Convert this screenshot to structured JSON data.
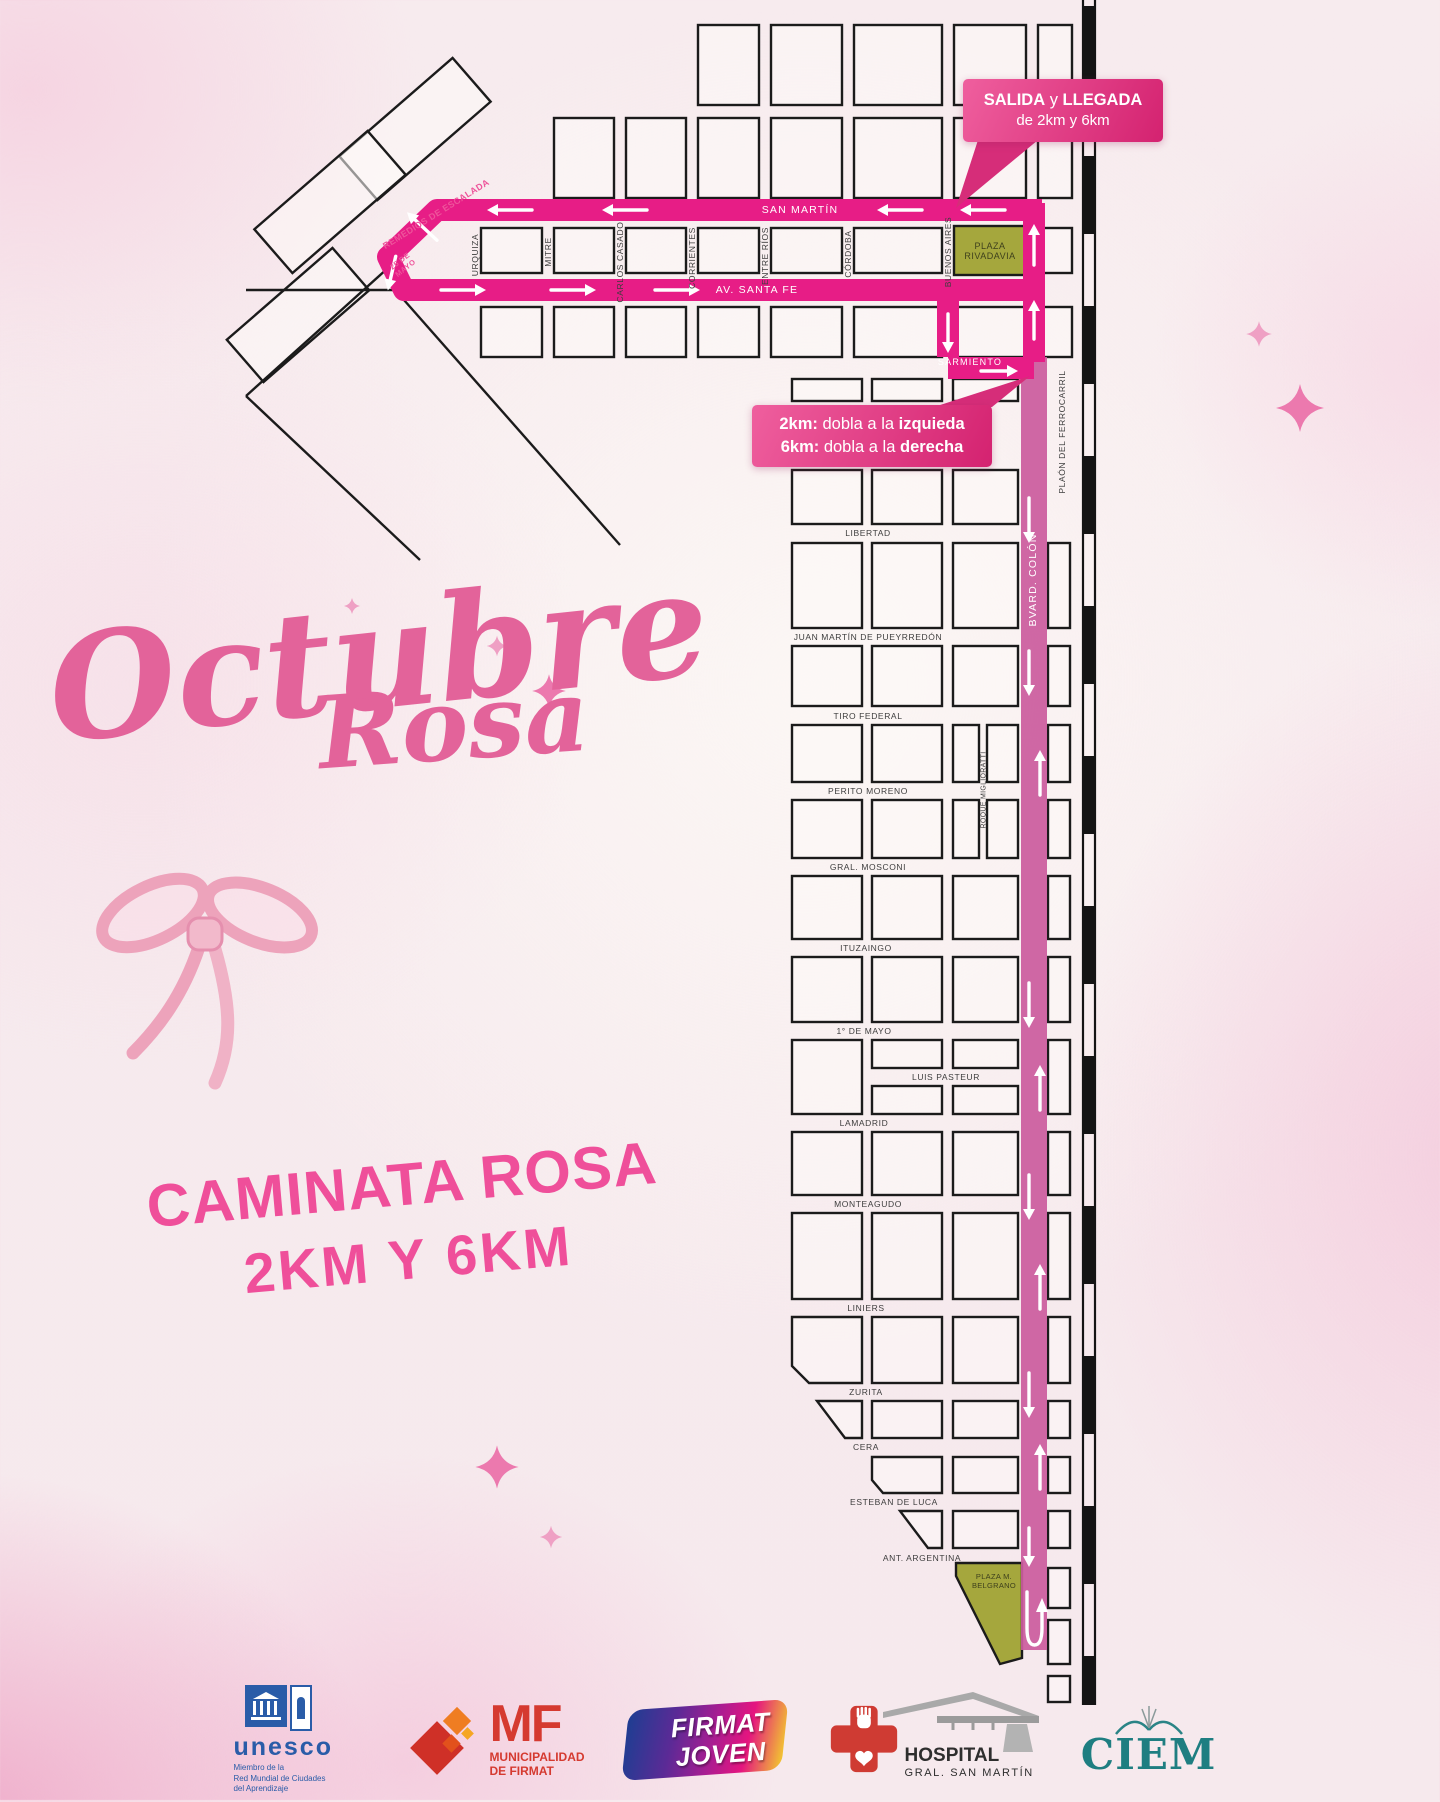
{
  "title": {
    "word1": "Octubre",
    "word2": "Rosa"
  },
  "subtitle": {
    "line1": "CAMINATA ROSA",
    "line2": "2KM Y 6KM"
  },
  "callout_start": {
    "bold1": "SALIDA",
    "mid": " y ",
    "bold2": "LLEGADA",
    "line2": "de 2km y 6km"
  },
  "callout_turn": {
    "rows": [
      {
        "b1": "2km:",
        "m": " dobla a la ",
        "b2": "izquieda"
      },
      {
        "b1": "6km:",
        "m": " dobla a la ",
        "b2": "derecha"
      }
    ]
  },
  "map": {
    "plazas": [
      {
        "lines": [
          "PLAZA",
          "RIVADAVIA"
        ]
      },
      {
        "lines": [
          "PLAZA M.",
          "BELGRANO"
        ]
      }
    ],
    "streets": [
      {
        "label": "SAN MARTÍN",
        "x": 800,
        "y": 210,
        "rot": 0,
        "cls": "route"
      },
      {
        "label": "AV. SANTA FE",
        "x": 757,
        "y": 290,
        "rot": 0,
        "cls": "route"
      },
      {
        "label": "SARMIENTO",
        "x": 970,
        "y": 362,
        "rot": 0,
        "cls": "route",
        "small": true
      },
      {
        "label": "BVARD. COLÓN",
        "x": 1033,
        "y": 580,
        "rot": -90,
        "cls": "route"
      },
      {
        "label": "REMEDIOS DE ESCALADA",
        "x": 436,
        "y": 214,
        "rot": -32,
        "cls": "pink"
      },
      {
        "label": "25 DE MAYO",
        "x": 403,
        "y": 265,
        "rot": -38,
        "cls": "pink wrap"
      },
      {
        "label": "URQUIZA",
        "x": 475,
        "y": 255,
        "rot": -90,
        "cls": ""
      },
      {
        "label": "MITRE",
        "x": 548,
        "y": 252,
        "rot": -90,
        "cls": ""
      },
      {
        "label": "CARLOS CASADO",
        "x": 620,
        "y": 262,
        "rot": -90,
        "cls": ""
      },
      {
        "label": "CORRIENTES",
        "x": 692,
        "y": 258,
        "rot": -90,
        "cls": ""
      },
      {
        "label": "ENTRE RÍOS",
        "x": 765,
        "y": 256,
        "rot": -90,
        "cls": ""
      },
      {
        "label": "CÓRDOBA",
        "x": 848,
        "y": 254,
        "rot": -90,
        "cls": ""
      },
      {
        "label": "BUENOS AIRES",
        "x": 948,
        "y": 252,
        "rot": -90,
        "cls": ""
      },
      {
        "label": "PLAÓN DEL FERROCARRIL",
        "x": 1062,
        "y": 432,
        "rot": -90,
        "cls": ""
      },
      {
        "label": "ROQUE MIGLIORATTI",
        "x": 984,
        "y": 790,
        "rot": -90,
        "cls": "tiny"
      },
      {
        "label": "LIBERTAD",
        "x": 868,
        "y": 533,
        "rot": 0,
        "cls": ""
      },
      {
        "label": "JUAN MARTÍN DE PUEYRREDÓN",
        "x": 868,
        "y": 637,
        "rot": 0,
        "cls": ""
      },
      {
        "label": "TIRO FEDERAL",
        "x": 868,
        "y": 716,
        "rot": 0,
        "cls": ""
      },
      {
        "label": "PERITO MORENO",
        "x": 868,
        "y": 791,
        "rot": 0,
        "cls": ""
      },
      {
        "label": "GRAL. MOSCONI",
        "x": 868,
        "y": 867,
        "rot": 0,
        "cls": ""
      },
      {
        "label": "ITUZAINGO",
        "x": 866,
        "y": 948,
        "rot": 0,
        "cls": ""
      },
      {
        "label": "1° DE MAYO",
        "x": 864,
        "y": 1031,
        "rot": 0,
        "cls": ""
      },
      {
        "label": "LUIS PASTEUR",
        "x": 946,
        "y": 1077,
        "rot": 0,
        "cls": ""
      },
      {
        "label": "LAMADRID",
        "x": 864,
        "y": 1123,
        "rot": 0,
        "cls": ""
      },
      {
        "label": "MONTEAGUDO",
        "x": 868,
        "y": 1204,
        "rot": 0,
        "cls": ""
      },
      {
        "label": "LINIERS",
        "x": 866,
        "y": 1308,
        "rot": 0,
        "cls": ""
      },
      {
        "label": "ZURITA",
        "x": 866,
        "y": 1392,
        "rot": 0,
        "cls": ""
      },
      {
        "label": "CERA",
        "x": 866,
        "y": 1447,
        "rot": 0,
        "cls": ""
      },
      {
        "label": "ESTEBAN DE LUCA",
        "x": 894,
        "y": 1502,
        "rot": 0,
        "cls": ""
      },
      {
        "label": "ANT. ARGENTINA",
        "x": 922,
        "y": 1558,
        "rot": 0,
        "cls": ""
      }
    ],
    "route": {
      "arrows": [
        {
          "x": 515,
          "y": 210,
          "d": 180
        },
        {
          "x": 630,
          "y": 210,
          "d": 180
        },
        {
          "x": 905,
          "y": 210,
          "d": 180
        },
        {
          "x": 988,
          "y": 210,
          "d": 180
        },
        {
          "x": 426,
          "y": 230,
          "d": 223,
          "len": 30
        },
        {
          "x": 393,
          "y": 268,
          "d": 103,
          "len": 24
        },
        {
          "x": 458,
          "y": 290,
          "d": 0
        },
        {
          "x": 568,
          "y": 290,
          "d": 0
        },
        {
          "x": 672,
          "y": 290,
          "d": 0
        },
        {
          "x": 948,
          "y": 328,
          "d": 90,
          "len": 28
        },
        {
          "x": 994,
          "y": 371,
          "d": 0,
          "len": 26
        },
        {
          "x": 1034,
          "y": 250,
          "d": 270,
          "len": 30
        },
        {
          "x": 1034,
          "y": 325,
          "d": 270,
          "len": 28
        },
        {
          "x": 1029,
          "y": 515,
          "d": 90
        },
        {
          "x": 1029,
          "y": 668,
          "d": 90
        },
        {
          "x": 1040,
          "y": 778,
          "d": 270
        },
        {
          "x": 1029,
          "y": 1000,
          "d": 90
        },
        {
          "x": 1040,
          "y": 1093,
          "d": 270
        },
        {
          "x": 1029,
          "y": 1192,
          "d": 90
        },
        {
          "x": 1040,
          "y": 1292,
          "d": 270
        },
        {
          "x": 1029,
          "y": 1390,
          "d": 90
        },
        {
          "x": 1040,
          "y": 1472,
          "d": 270
        },
        {
          "x": 1029,
          "y": 1542,
          "d": 90,
          "len": 28
        }
      ]
    }
  },
  "footer": {
    "unesco": {
      "wordmark": "unesco",
      "lines": [
        "Miembro de la",
        "Red Mundial de Ciudades",
        "del Aprendizaje"
      ]
    },
    "mf": {
      "initials": "MF",
      "lines": [
        "MUNICIPALIDAD",
        "DE FIRMAT"
      ]
    },
    "firmat_joven": {
      "lines": [
        "FIRMAT",
        "JOVEN"
      ]
    },
    "hospital": {
      "name": "HOSPITAL",
      "subname": "GRAL. SAN MARTÍN"
    },
    "ciem": {
      "name": "CIEM"
    }
  },
  "colors": {
    "route_pink": "#e71d86",
    "route_mauve": "#cb5c9e",
    "callout_pink": "#d62d79",
    "plaza_olive": "#a5a73d",
    "title_pink": "#e3639a",
    "subtitle_pink": "#ef4f9a"
  }
}
